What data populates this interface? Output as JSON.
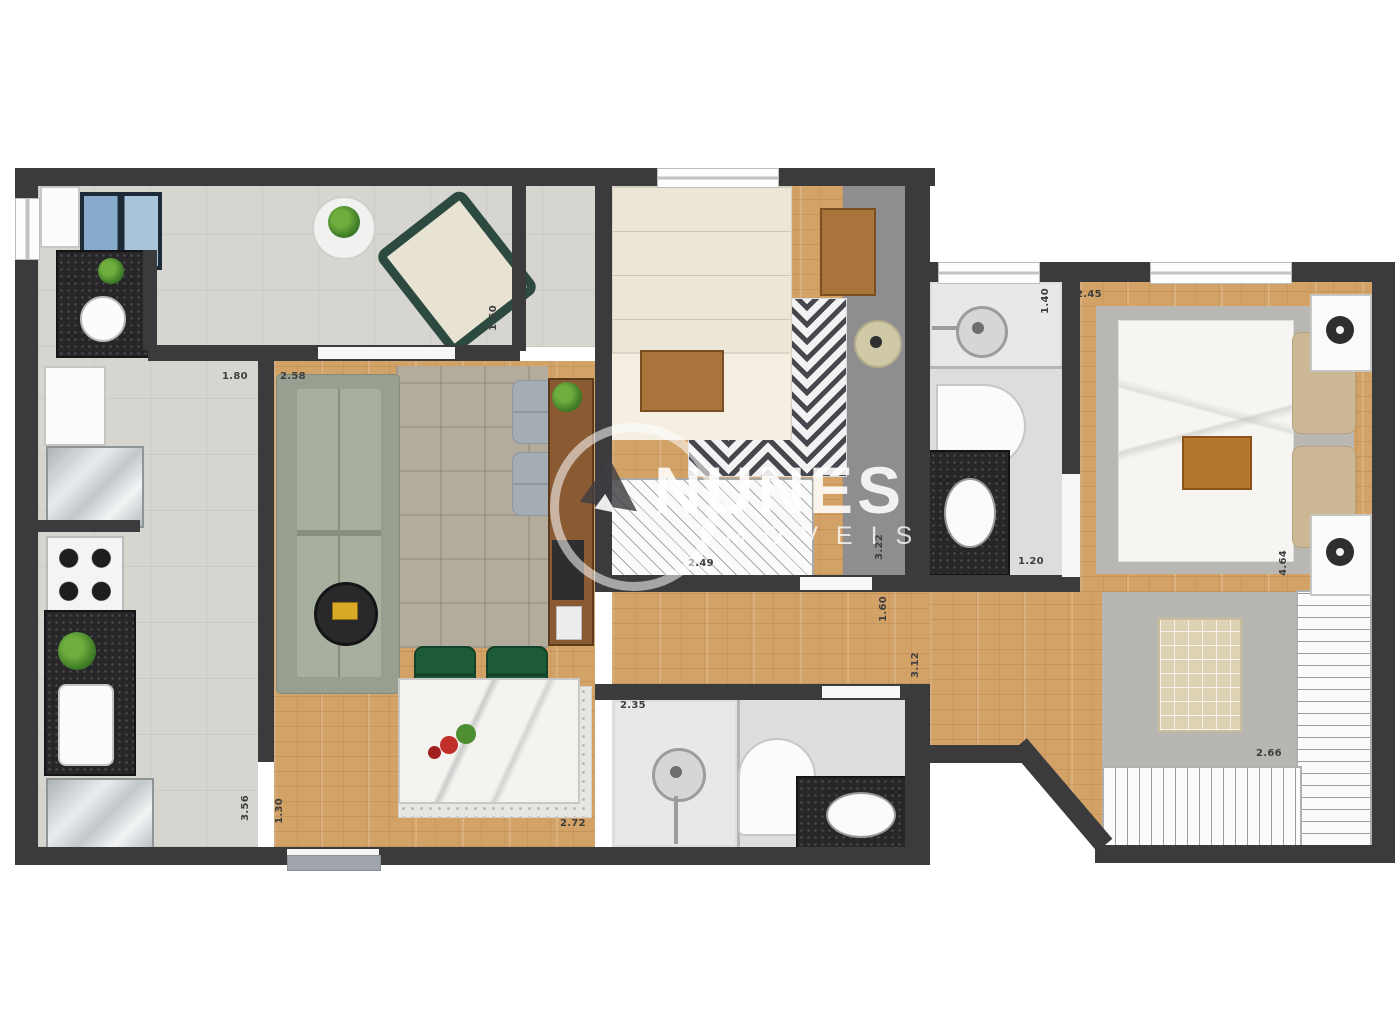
{
  "watermark": {
    "brand": "NUNES",
    "subtext": "IMÓVEIS"
  },
  "dimensions": {
    "kitchen_top": "1.80",
    "living_top": "2.58",
    "nook_depth": "1.50",
    "bedroom2_closet": "2.49",
    "bedroom2_length": "3.22",
    "hall_width": "1.60",
    "hall_length": "3.12",
    "suite_bath_width": "1.40",
    "master_width": "2.45",
    "suite_bath_bottom": "1.20",
    "master_length": "4.64",
    "closet_width": "2.66",
    "dining_width": "2.72",
    "social_bath_width": "2.35",
    "kitchen_length": "3.56",
    "entry_width": "1.30"
  },
  "colors": {
    "wall": "#3b3b3d",
    "wood_floor": "#d3a267",
    "tile_floor": "#d7d5cf",
    "bath_floor": "#dedddb",
    "chevron_rug": "#47474f",
    "sofa": "#97a090",
    "dining_chair_green": "#1d5b38",
    "granite_counter": "#27272a",
    "accent_yellow": "#d9a928",
    "watermark_text": "#ffffff"
  }
}
